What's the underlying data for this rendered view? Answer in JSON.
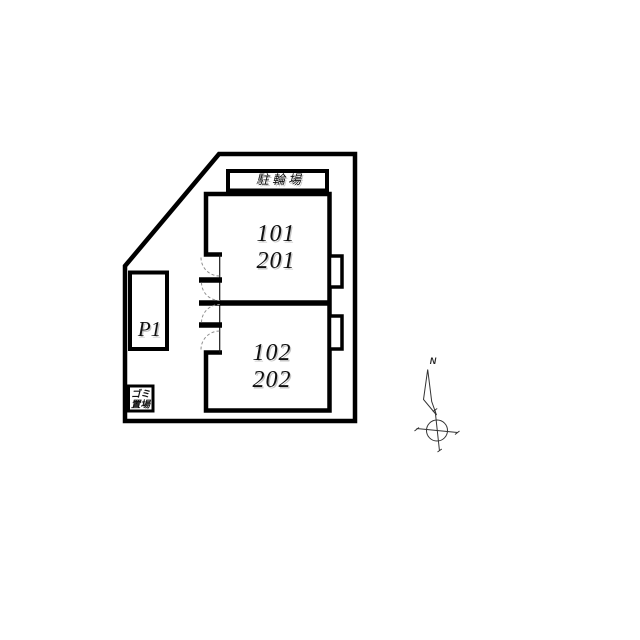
{
  "colors": {
    "line": "#000000",
    "background": "#ffffff",
    "door_arc": "#8f8f8f",
    "text_shadow": "#c6c6c6"
  },
  "plan": {
    "bicycle_parking_label": "駐輪場",
    "unit_top": {
      "first_floor": "101",
      "second_floor": "201"
    },
    "unit_bottom": {
      "first_floor": "102",
      "second_floor": "202"
    },
    "parking_space_label": "P1",
    "garbage_area": {
      "line1": "ゴミ",
      "line2": "置場"
    },
    "compass": {
      "north_label": "N"
    }
  }
}
